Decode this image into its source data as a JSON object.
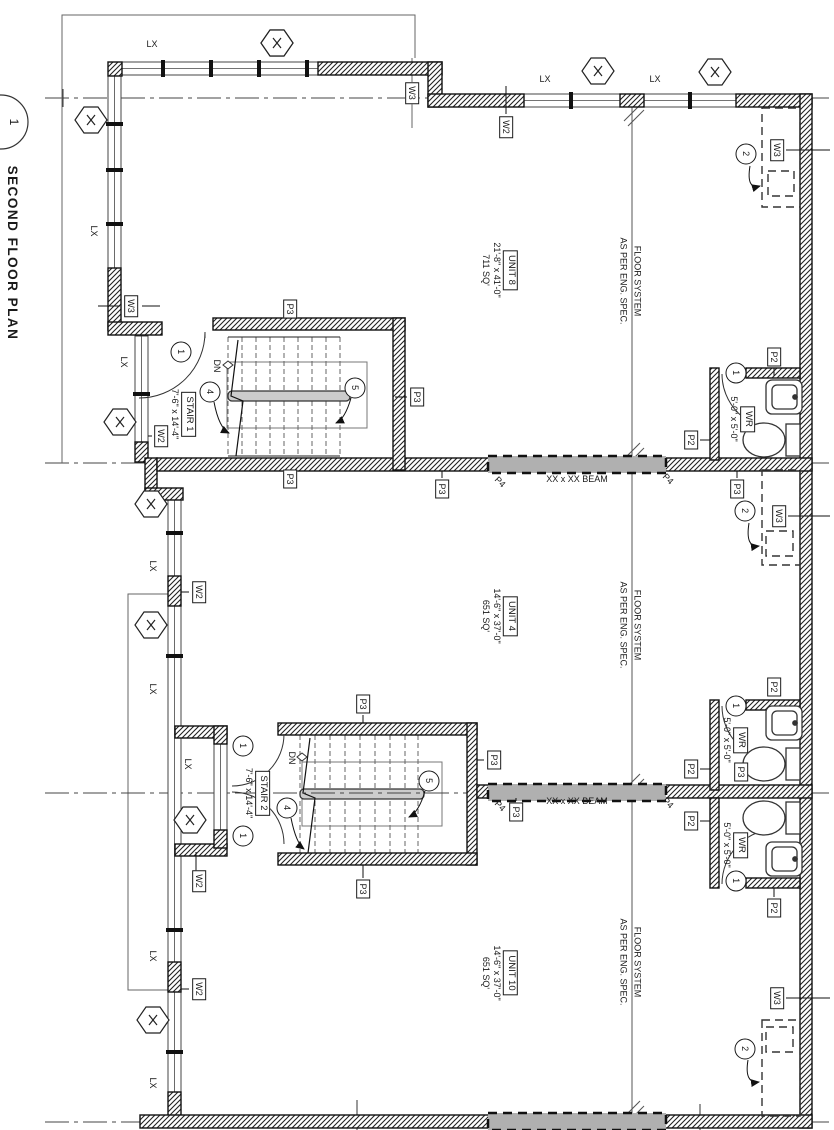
{
  "drawing": {
    "title": "SECOND FLOOR PLAN",
    "title_bubble": "1",
    "line_color": "#1a1a1a"
  },
  "tags": {
    "lx": "LX",
    "w2": "W2",
    "w3": "W3",
    "p2": "P2",
    "p3": "P3",
    "p4": "P4",
    "dn": "DN",
    "beam": "XX x XX BEAM"
  },
  "bubbles": {
    "one": "1",
    "two": "2",
    "four": "4",
    "five": "5"
  },
  "units": [
    {
      "name": "UNIT 8",
      "dims": "21'-8\" x 41'-0\"",
      "area": "711 SQ'"
    },
    {
      "name": "UNIT 4",
      "dims": "14'-6\" x 37'-0\"",
      "area": "651 SQ'"
    },
    {
      "name": "UNIT 10",
      "dims": "14'-6\" x 37'-0\"",
      "area": "651 SQ'"
    }
  ],
  "stairs": [
    {
      "name": "STAIR 1",
      "dims": "7'-6\" x 14'-4\""
    },
    {
      "name": "STAIR 2",
      "dims": "7'-6\" x 14'-4\""
    }
  ],
  "washroom": {
    "label": "WR",
    "dims": "5'-0\" x 5'-0\""
  },
  "floor_note": {
    "line1": "FLOOR SYSTEM",
    "line2": "AS PER ENG. SPEC."
  }
}
